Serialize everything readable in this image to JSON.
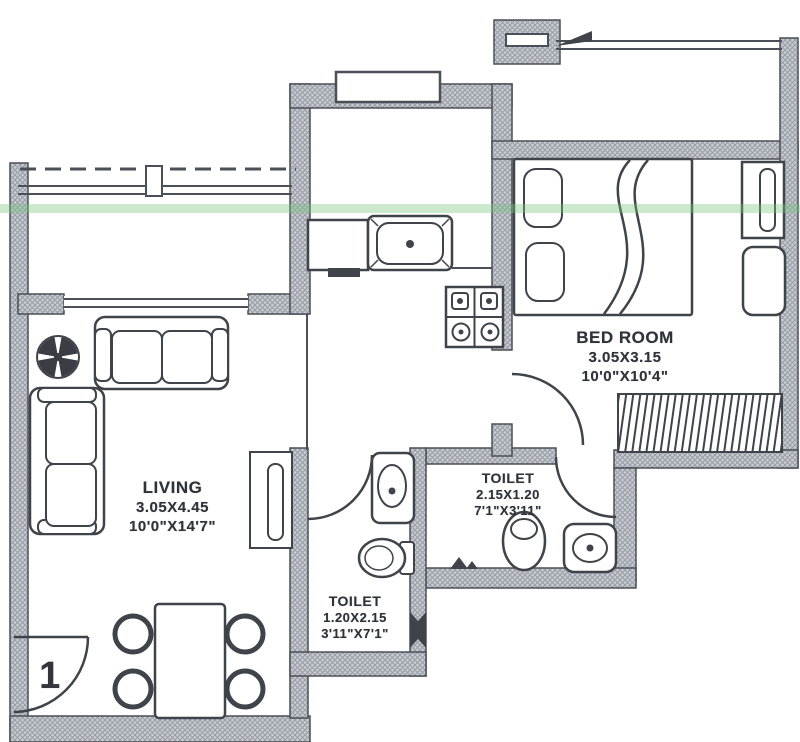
{
  "rooms": {
    "living": {
      "name": "LIVING",
      "dim_m": "3.05X4.45",
      "dim_ft": "10'0\"X14'7\""
    },
    "bedroom": {
      "name": "BED ROOM",
      "dim_m": "3.05X3.15",
      "dim_ft": "10'0\"X10'4\""
    },
    "toilet_small": {
      "name": "TOILET",
      "dim_m": "1.20X2.15",
      "dim_ft": "3'11\"X7'1\""
    },
    "toilet_large": {
      "name": "TOILET",
      "dim_m": "2.15X1.20",
      "dim_ft": "7'1\"X3'11\""
    }
  },
  "unit_number": "1",
  "colors": {
    "wall_fill": "#c9ccd2",
    "wall_hatch": "#979ba4",
    "line": "#4b4f57",
    "accent_green": "#79c47e",
    "background": "#ffffff"
  }
}
